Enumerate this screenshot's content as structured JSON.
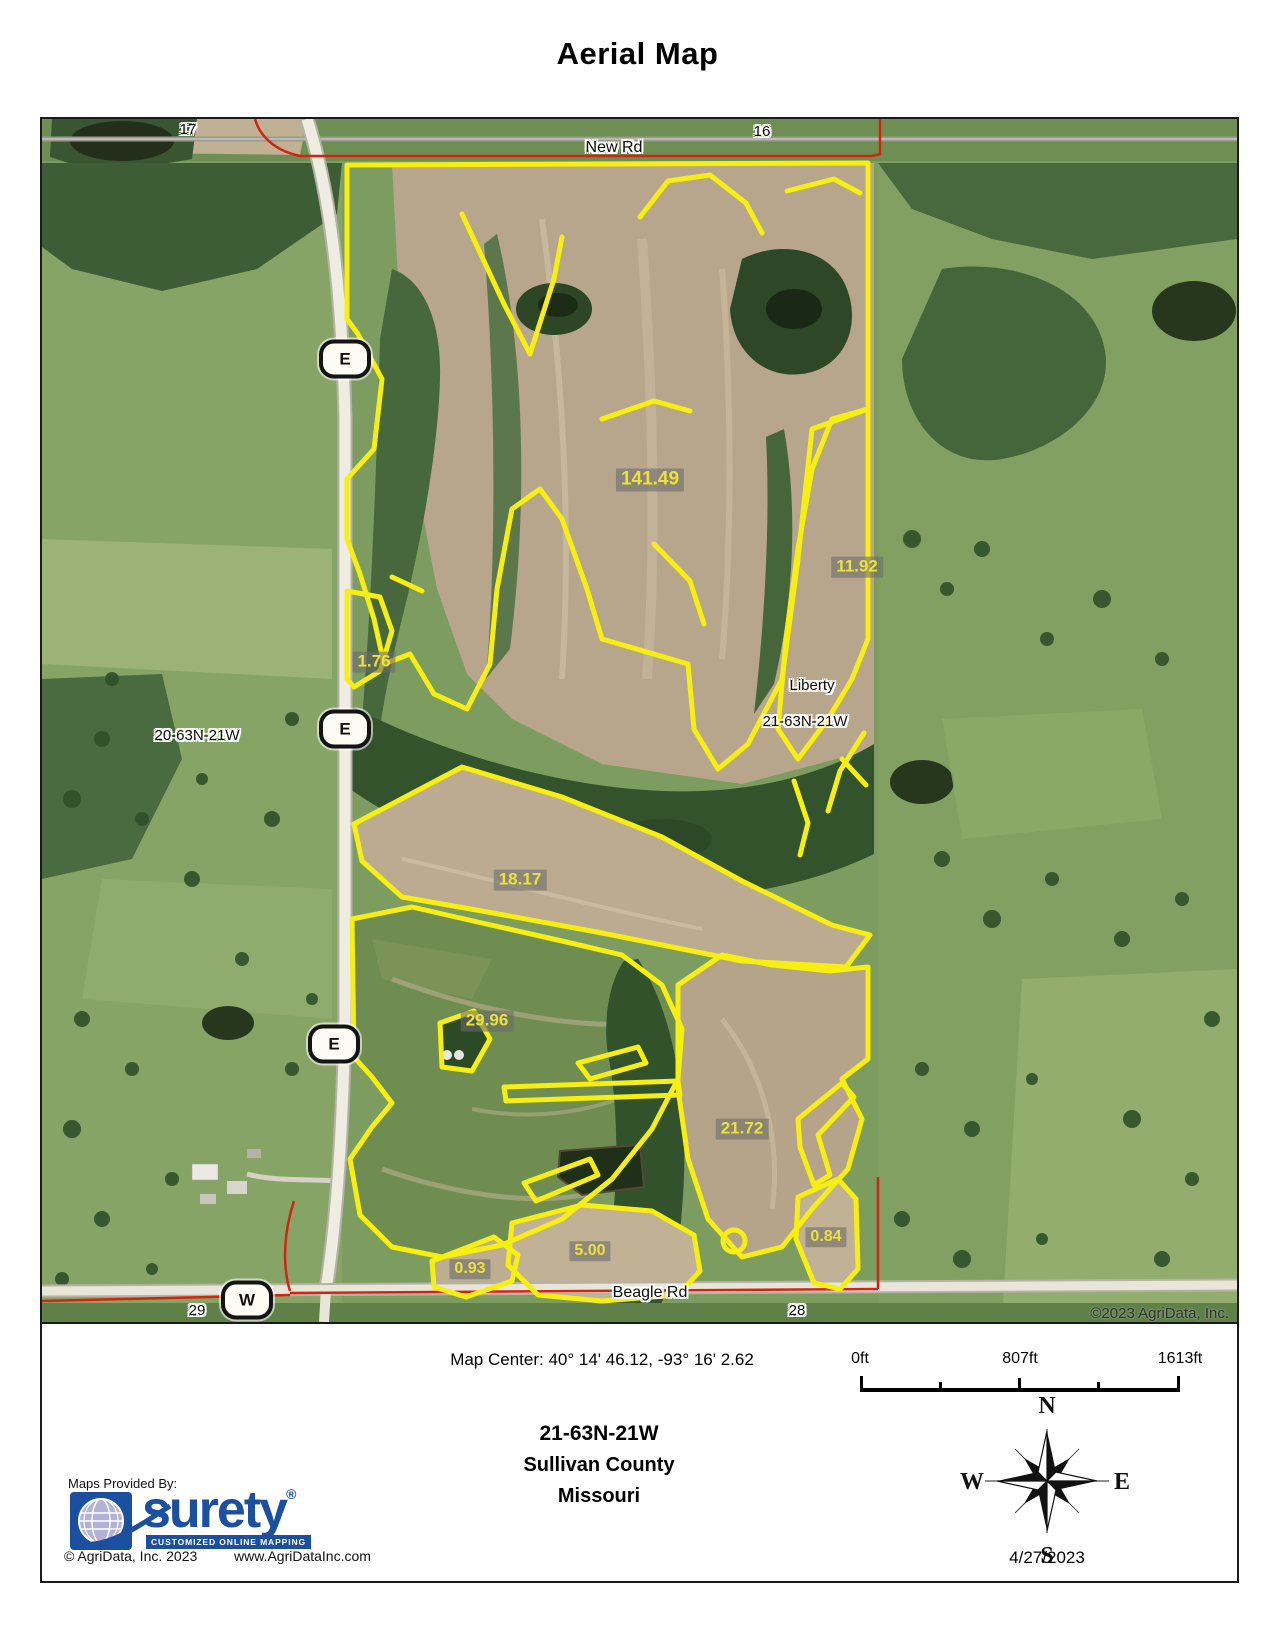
{
  "title": "Aerial Map",
  "map": {
    "roads": {
      "new_rd": "New Rd",
      "beagle_rd": "Beagle Rd"
    },
    "sections": {
      "s17": "17",
      "s16": "16",
      "s29": "29",
      "s28": "28"
    },
    "townships": {
      "west": "20-63N-21W",
      "liberty": "Liberty",
      "current": "21-63N-21W"
    },
    "markers": {
      "e": "E",
      "w": "W"
    },
    "parcels": {
      "p1": "141.49",
      "p2": "11.92",
      "p3": "1.76",
      "p4": "18.17",
      "p5": "29.96",
      "p6": "21.72",
      "p7": "5.00",
      "p8": "0.93",
      "p9": "0.84"
    },
    "copyright": "©2023 AgriData, Inc."
  },
  "footer": {
    "map_center": "Map Center: 40° 14' 46.12,  -93° 16' 2.62",
    "scale": {
      "zero": "0ft",
      "mid": "807ft",
      "end": "1613ft"
    },
    "location": {
      "township": "21-63N-21W",
      "county": "Sullivan County",
      "state": "Missouri"
    },
    "provider": {
      "label": "Maps Provided By:",
      "brand": "surety",
      "reg": "®",
      "tagline": "CUSTOMIZED ONLINE MAPPING",
      "copyright": "© AgriData, Inc. 2023",
      "website": "www.AgriDataInc.com"
    },
    "compass": {
      "n": "N",
      "s": "S",
      "e": "E",
      "w": "W"
    },
    "date": "4/27/2023"
  },
  "colors": {
    "boundary_yellow": "#f8ef12",
    "section_line_red": "#d2250f",
    "acreage_text": "#ebe23c",
    "brand_blue": "#1b4fa0"
  }
}
